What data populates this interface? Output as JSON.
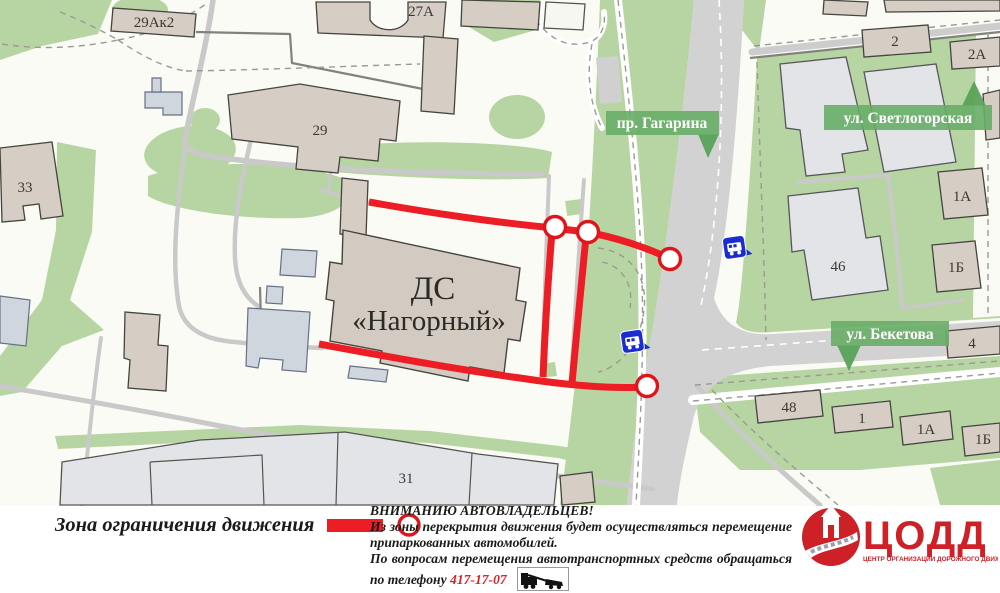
{
  "map": {
    "streets": [
      {
        "label": "пр. Гагарина",
        "arrow": "down"
      },
      {
        "label": "ул. Светлогорская",
        "arrow": "up"
      },
      {
        "label": "ул. Бекетова",
        "arrow": "down"
      }
    ],
    "venue": {
      "line1": "ДС",
      "line2": "«Нагорный»"
    },
    "buildings": [
      "29Ак2",
      "27А",
      "29",
      "33",
      "2",
      "2А",
      "1А",
      "1Б",
      "46",
      "4",
      "48",
      "1",
      "1А",
      "1Б",
      "31"
    ],
    "colors": {
      "restriction_red": "#ec1d24",
      "street_banner_green": "#67ad67",
      "bus_icon_blue": "#1b2cd1",
      "green_area": "#b7d5a2",
      "building_tan": "#d6cdc4",
      "road_gray": "#d2d2d2"
    }
  },
  "legend": {
    "zone_label": "Зона ограничения движения"
  },
  "notice": {
    "title": "ВНИМАНИЮ АВТОВЛАДЕЛЬЦЕВ!",
    "body1": "Из зоны перекрытия движения будет осуществляться перемещение припаркованных автомобилей.",
    "body2_prefix": "По вопросам перемещения автотранспортных средств обращаться по телефону ",
    "phone": "417-17-07"
  },
  "logo": {
    "name": "ЦОДД",
    "subtitle": "ЦЕНТР ОРГАНИЗАЦИИ ДОРОЖНОГО ДВИЖЕНИЯ"
  }
}
